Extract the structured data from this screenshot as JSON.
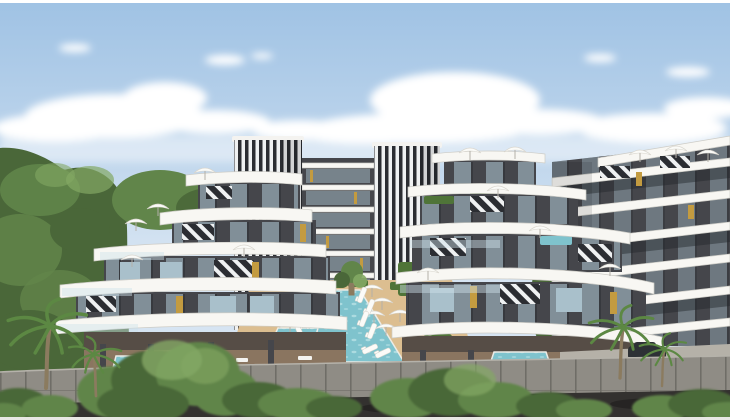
{
  "scene": {
    "setting": "Architectural rendering of a modern residential apartment complex with curved white balconies, louvered screen towers, landscaped courtyard, swimming pools, sun umbrellas and palm trees under a blue sky with cumulus clouds",
    "elements": [
      "sky with cumulus clouds",
      "background trees",
      "left apartment building with curved white balcony slabs",
      "right apartment building with curved white balcony slabs",
      "central apartment block",
      "far-right apartment block",
      "vertical black-and-white louver towers",
      "diagonal striped facade panels",
      "gold window accents",
      "main swimming pool",
      "kids pool",
      "ground-floor plunge pools",
      "rooftop plunge pool",
      "sun umbrellas",
      "sun loungers",
      "green hedges",
      "sand-colored pool deck",
      "stone perimeter wall",
      "asphalt road",
      "front shrubs",
      "palm trees",
      "parked car"
    ]
  },
  "palette": {
    "sky_top": "#9fc2e4",
    "sky_bottom": "#d6e4f2",
    "cloud_white": "#ffffff",
    "tree_dark": "#4a6739",
    "tree_mid": "#61854a",
    "tree_light": "#83a864",
    "facade_dark": "#45464b",
    "terrace_floor": "#8a7560",
    "slab_white": "#f8f7f3",
    "slab_shadow": "#cdccc6",
    "window_glass": "#a9c0cb",
    "window_dark": "#22262b",
    "stripe_dark": "#2b2d32",
    "stripe_light": "#eff1f2",
    "gold_accent": "#c39b40",
    "pool_water": "#7fc3cd",
    "pool_light": "#bfe6e9",
    "pool_edge": "#ecebe6",
    "deck_sand": "#dcbe90",
    "hedge_green": "#4f7438",
    "wall_stone": "#8f8c85",
    "wall_joint": "#6f6d67",
    "road_asphalt": "#33312f",
    "trim_white": "#f4f3f0",
    "umbrella_white": "#fbfbf8",
    "palm_green": "#5c8843",
    "palm_trunk": "#8b7b5f",
    "pavement_gray": "#b5b1a8",
    "car_dark": "#2d3135",
    "railing_glass": "#cfe2ea"
  }
}
